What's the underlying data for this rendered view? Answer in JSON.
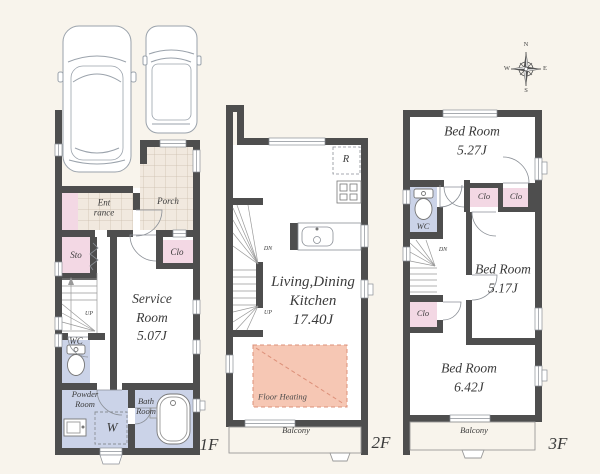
{
  "colors": {
    "background": "#f8f4ec",
    "wall": "#4e4e4e",
    "closet_pink": "#f3d8e4",
    "wet_room_lavender": "#cbd3e8",
    "tile_beige": "#f1e9df",
    "tile_line": "#c9bcab",
    "floor_heating_fill": "#f6c7b4",
    "floor_heating_line": "#dc9079",
    "thin_line": "#8a8f96",
    "text": "#3b3b3b"
  },
  "compass": {
    "north": "N",
    "east": "E",
    "south": "S",
    "west": "W"
  },
  "floor1": {
    "label": "1F",
    "entrance": "Ent\nrance",
    "porch": "Porch",
    "storage": "Sto",
    "closet": "Clo",
    "service_room": "Service\nRoom\n5.07J",
    "wc": "WC",
    "up": "UP",
    "powder_room": "Powder\nRoom",
    "washer": "W",
    "bath_room": "Bath\nRoom"
  },
  "floor2": {
    "label": "2F",
    "refrigerator": "R",
    "living_dining_kitchen": "Living,Dining\nKitchen\n17.40J",
    "floor_heating": "Floor Heating",
    "balcony": "Balcony",
    "down": "DN",
    "up": "UP"
  },
  "floor3": {
    "label": "3F",
    "bedroom_1": "Bed Room\n5.27J",
    "closet_1": "Clo",
    "closet_2": "Clo",
    "wc": "WC",
    "down": "DN",
    "closet_3": "Clo",
    "bedroom_2": "Bed Room\n5.17J",
    "bedroom_3": "Bed Room\n6.42J",
    "balcony": "Balcony"
  }
}
